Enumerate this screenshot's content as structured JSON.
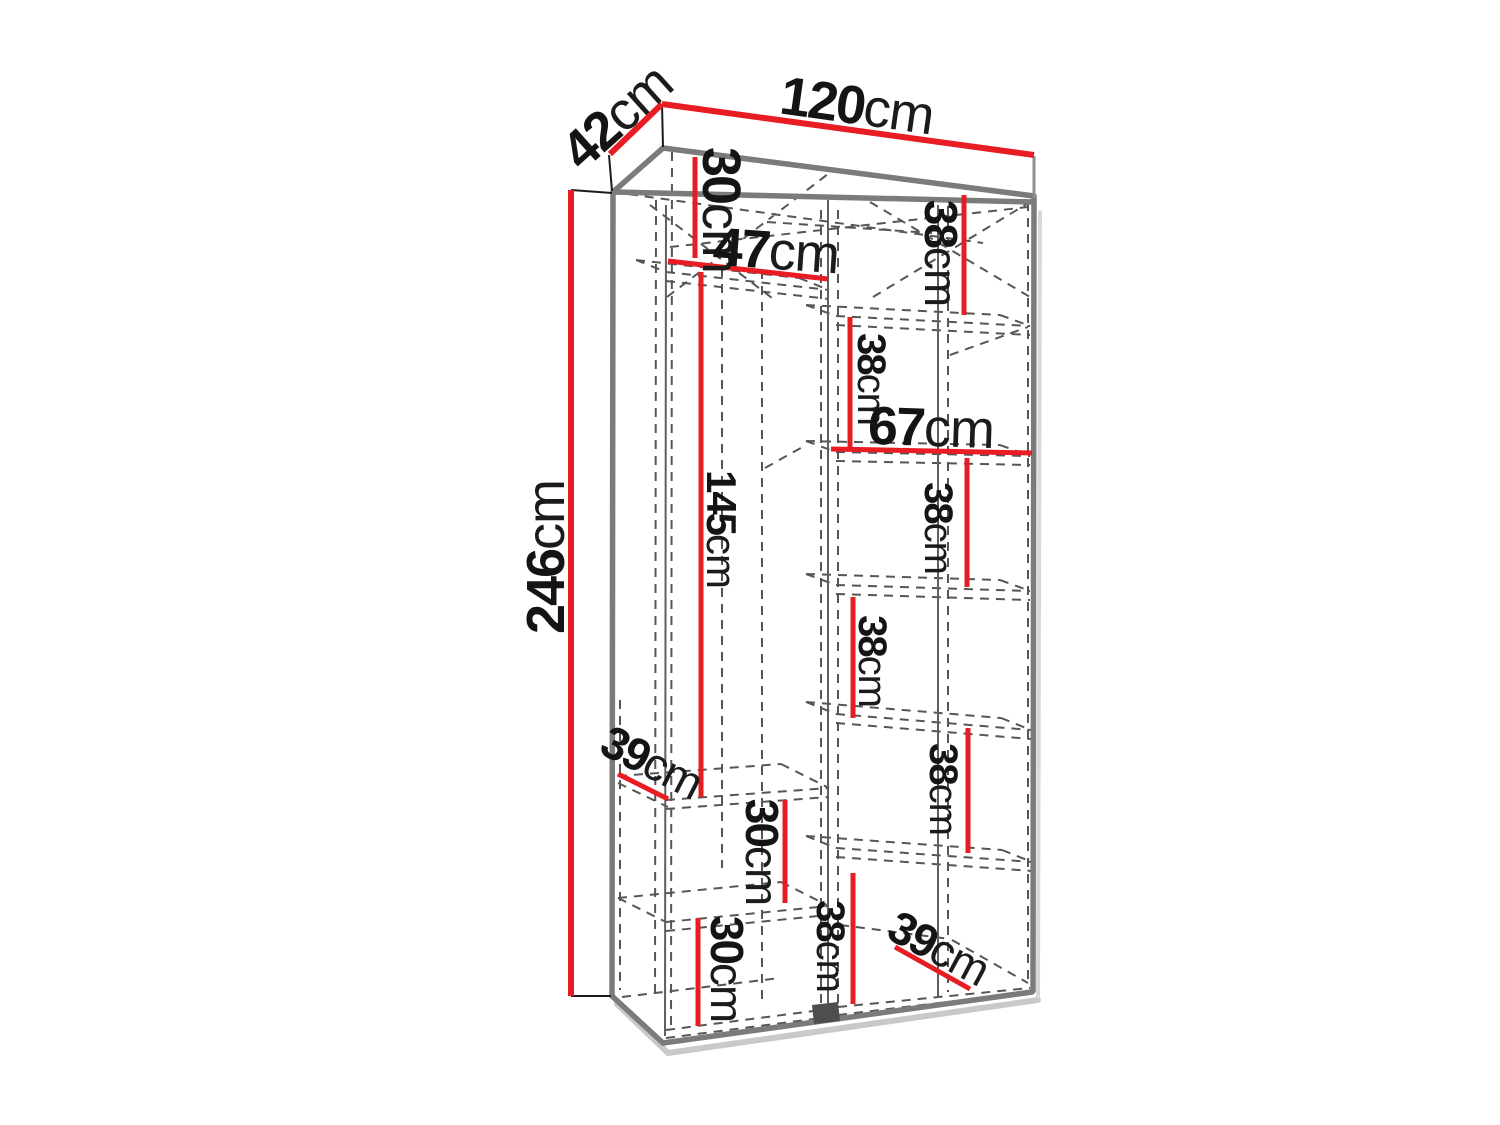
{
  "figure": {
    "kind": "furniture dimension diagram",
    "subject": "two-section wardrobe line drawing with shelf dimensions",
    "unit": "cm"
  },
  "overall_dimensions": {
    "width_cm": 120,
    "depth_cm": 42,
    "height_cm": 246
  },
  "sections": {
    "left": {
      "width_cm": 47,
      "gaps_top_to_bottom_cm": [
        30,
        145,
        30,
        30
      ],
      "shelf_depth_cm": 39
    },
    "right": {
      "width_cm": 67,
      "gaps_top_to_bottom_cm": [
        38,
        38,
        38,
        38,
        38,
        38
      ],
      "shelf_depth_cm": 39
    }
  },
  "colors": {
    "dimension_line": "#e81c23",
    "outline": "#7b7b7b",
    "hidden_line": "#565656",
    "label_text": "#141414",
    "background": "#ffffff"
  },
  "labels": [
    {
      "name": "depth-42",
      "value": "42",
      "unit": "cm",
      "x": 617,
      "y": 117,
      "rot": -42,
      "size": "lg"
    },
    {
      "name": "width-120",
      "value": "120",
      "unit": "cm",
      "x": 857,
      "y": 106,
      "rot": 8,
      "size": "lg"
    },
    {
      "name": "left-top-30",
      "value": "30",
      "unit": "cm",
      "x": 721,
      "y": 210,
      "rot": 90,
      "size": "xl"
    },
    {
      "name": "left-47",
      "value": "47",
      "unit": "cm",
      "x": 776,
      "y": 251,
      "rot": 4,
      "size": "xl"
    },
    {
      "name": "right-top-38",
      "value": "38",
      "unit": "cm",
      "x": 941,
      "y": 253,
      "rot": 90,
      "size": "ms"
    },
    {
      "name": "right-38-b",
      "value": "38",
      "unit": "cm",
      "x": 871,
      "y": 379,
      "rot": 90,
      "size": "sm"
    },
    {
      "name": "right-67",
      "value": "67",
      "unit": "cm",
      "x": 931,
      "y": 428,
      "rot": 2,
      "size": "xl"
    },
    {
      "name": "left-145",
      "value": "145",
      "unit": "cm",
      "x": 721,
      "y": 529,
      "rot": 90,
      "size": "m145"
    },
    {
      "name": "right-38-c",
      "value": "38",
      "unit": "cm",
      "x": 938,
      "y": 528,
      "rot": 90,
      "size": "sm"
    },
    {
      "name": "right-38-d",
      "value": "38",
      "unit": "cm",
      "x": 872,
      "y": 661,
      "rot": 90,
      "size": "sm"
    },
    {
      "name": "left-39",
      "value": "39",
      "unit": "cm",
      "x": 652,
      "y": 762,
      "rot": 27,
      "size": "md"
    },
    {
      "name": "right-38-e",
      "value": "38",
      "unit": "cm",
      "x": 943,
      "y": 789,
      "rot": 90,
      "size": "sm"
    },
    {
      "name": "left-mid-30",
      "value": "30",
      "unit": "cm",
      "x": 762,
      "y": 852,
      "rot": 90,
      "size": "md"
    },
    {
      "name": "bottom-38",
      "value": "38",
      "unit": "cm",
      "x": 830,
      "y": 946,
      "rot": 90,
      "size": "sm"
    },
    {
      "name": "bottom-right-39",
      "value": "39",
      "unit": "cm",
      "x": 939,
      "y": 948,
      "rot": 28,
      "size": "md"
    },
    {
      "name": "bottom-left-30",
      "value": "30",
      "unit": "cm",
      "x": 727,
      "y": 969,
      "rot": 90,
      "size": "md"
    },
    {
      "name": "height-246",
      "value": "246",
      "unit": "cm",
      "x": 546,
      "y": 557,
      "rot": -90,
      "size": "lg"
    }
  ]
}
